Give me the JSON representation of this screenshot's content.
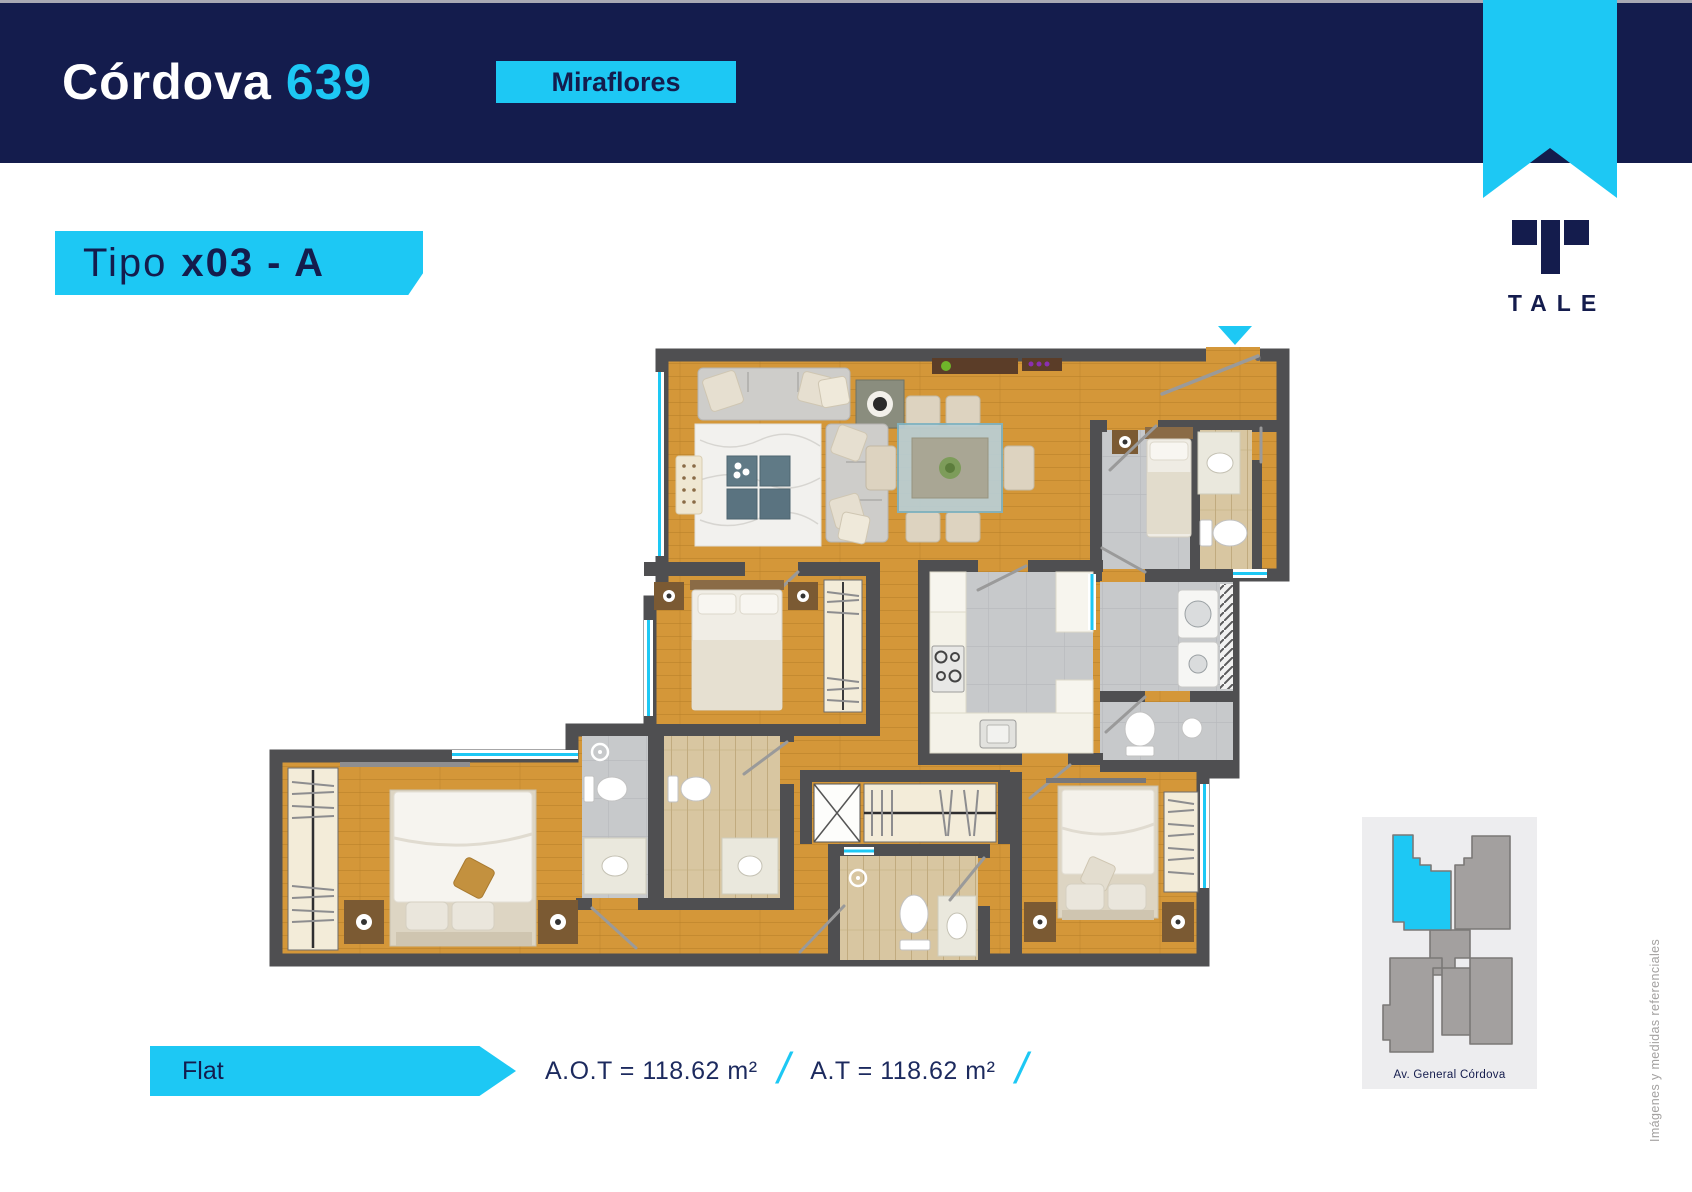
{
  "header": {
    "title": "Córdova",
    "number": "639",
    "location_badge": "Miraflores"
  },
  "brand": {
    "logo_text": "TALE"
  },
  "unit": {
    "type_prefix": "Tipo",
    "type_code": "x03 - A",
    "category_label": "Flat",
    "area_ot": "A.O.T = 118.62 m²",
    "area_t": "A.T = 118.62 m²",
    "separator": "/"
  },
  "minimap": {
    "street_label": "Av. General Córdova"
  },
  "footnote": "Imágenes y medidas referenciales",
  "colors": {
    "navy": "#141c4d",
    "cyan": "#1dc8f4",
    "white": "#ffffff",
    "wood": "#d49739",
    "wall": "#4f4f51",
    "tile_gray": "#c7c9cb",
    "tile_beige": "#d8c6a1",
    "map_bg": "#ededef",
    "map_building": "#a3a09f",
    "map_outline": "#7b7877",
    "footnote_gray": "#a3a1a0"
  }
}
